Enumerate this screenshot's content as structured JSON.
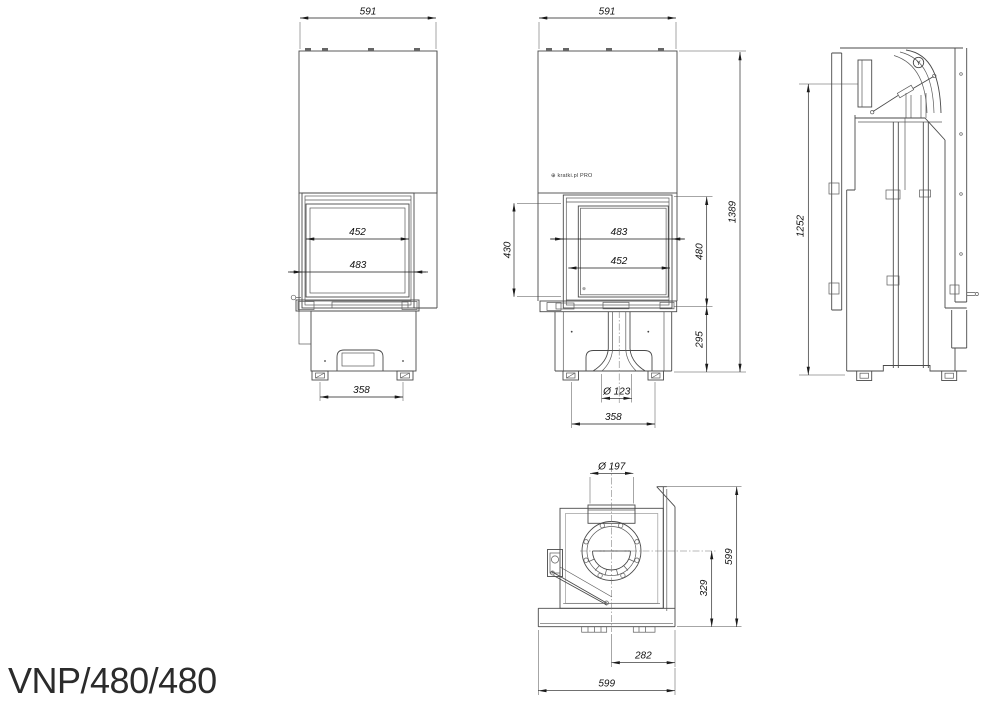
{
  "title": "VNP/480/480",
  "brand": {
    "logo": "⊕ kratki.pl PRO",
    "glass_mark": "⊕",
    "valve_mark": "Y"
  },
  "colors": {
    "background": "#ffffff",
    "line": "#4a4a4a",
    "dimension": "#1a1a1a"
  },
  "views": {
    "front_left": {
      "dims": {
        "overall_width": "591",
        "glass_width": "452",
        "frame_width": "483",
        "feet_spacing": "358"
      }
    },
    "front_center": {
      "dims": {
        "overall_width": "591",
        "glass_height": "430",
        "frame_width": "483",
        "glass_width": "452",
        "firebox_height": "480",
        "base_height": "295",
        "overall_height": "1389",
        "air_inlet_diameter": "Ø 123",
        "feet_spacing": "358"
      }
    },
    "side": {
      "dims": {
        "body_height": "1252"
      }
    },
    "top": {
      "dims": {
        "flue_diameter": "Ø 197",
        "flue_axis_to_front": "329",
        "side_depth": "599",
        "flue_axis_to_side": "282",
        "overall_depth": "599"
      }
    }
  }
}
